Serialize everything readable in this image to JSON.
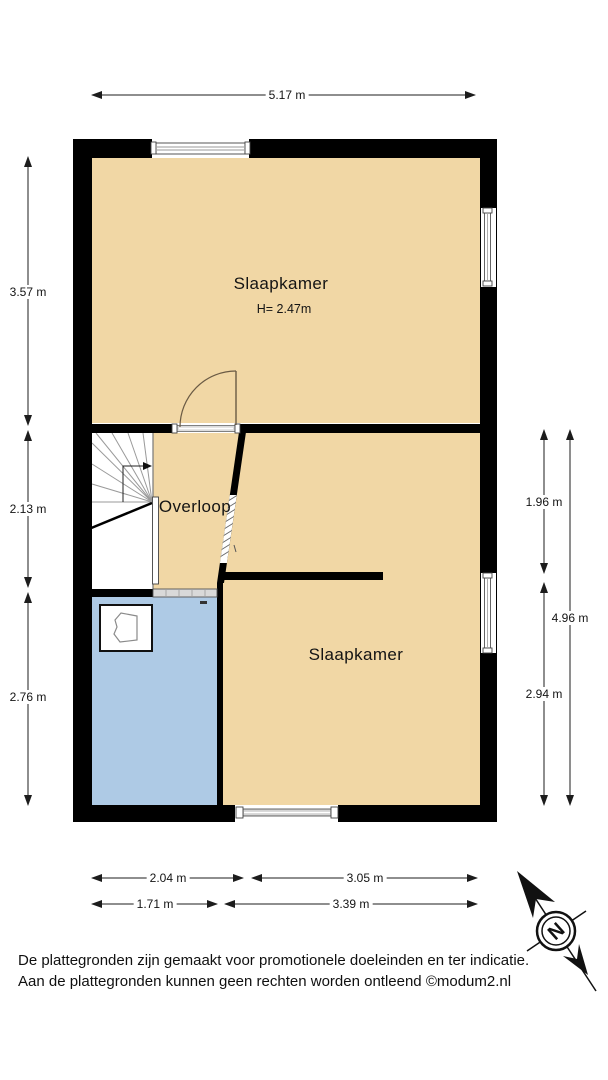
{
  "floorplan": {
    "rooms": [
      {
        "name": "Slaapkamer",
        "height_label": "H= 2.47m"
      },
      {
        "name": "Overloop"
      },
      {
        "name": "Slaapkamer"
      }
    ],
    "dimensions": {
      "top": "5.17 m",
      "left": [
        "3.57 m",
        "2.13 m",
        "2.76 m"
      ],
      "right": [
        "1.96 m",
        "4.96 m",
        "2.94 m"
      ],
      "bottom_row1": [
        "2.04 m",
        "3.05 m"
      ],
      "bottom_row2": [
        "1.71 m",
        "3.39 m"
      ]
    },
    "compass": {
      "letter": "N"
    },
    "colors": {
      "room_fill": "#F1D7A5",
      "bathroom_fill": "#AECAE5",
      "wall": "#000000"
    },
    "disclaimer": [
      "De plattegronden zijn gemaakt voor promotionele doeleinden en ter indicatie.",
      "Aan de plattegronden kunnen geen rechten worden ontleend ©modum2.nl"
    ]
  }
}
